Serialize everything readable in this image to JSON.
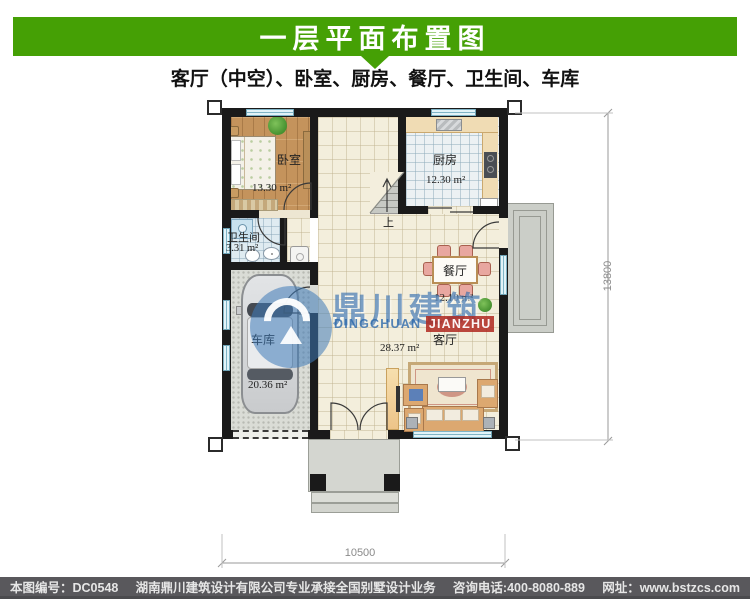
{
  "header": {
    "title": "一层平面布置图"
  },
  "subtitle": "客厅（中空）、卧室、厨房、餐厅、卫生间、车库",
  "plan": {
    "rooms": [
      {
        "id": "bedroom",
        "name": "卧室",
        "area": "13.30 m²"
      },
      {
        "id": "kitchen",
        "name": "厨房",
        "area": "12.30 m²"
      },
      {
        "id": "bathroom",
        "name": "卫生间",
        "area": "3.31 m²"
      },
      {
        "id": "dining",
        "name": "餐厅",
        "area": "12.10 m²"
      },
      {
        "id": "garage",
        "name": "车库",
        "area": "20.36 m²"
      },
      {
        "id": "living",
        "name": "客厅",
        "area": "28.37 m²"
      }
    ],
    "stairs_up_label": "上",
    "dimensions": {
      "bottom_width": "10500",
      "right_height": "13800"
    }
  },
  "watermark": {
    "cn": "鼎川建筑",
    "en_first": "DINGCHUAN ",
    "en_last": "JIANZHU"
  },
  "footer": {
    "drawing_no": "本图编号：DC0548",
    "company": "湖南鼎川建筑设计有限公司专业承接全国别墅设计业务",
    "phone": "咨询电话:400-8080-889",
    "website": "网址：www.bstzcs.com"
  },
  "colors": {
    "accent_green": "#45A005",
    "footer_gray": "#59585C",
    "watermark_blue": "#2C68AA",
    "watermark_red": "#AF2820",
    "wall_black": "#1A1A1A",
    "window_cyan": "#E2F3F8"
  }
}
